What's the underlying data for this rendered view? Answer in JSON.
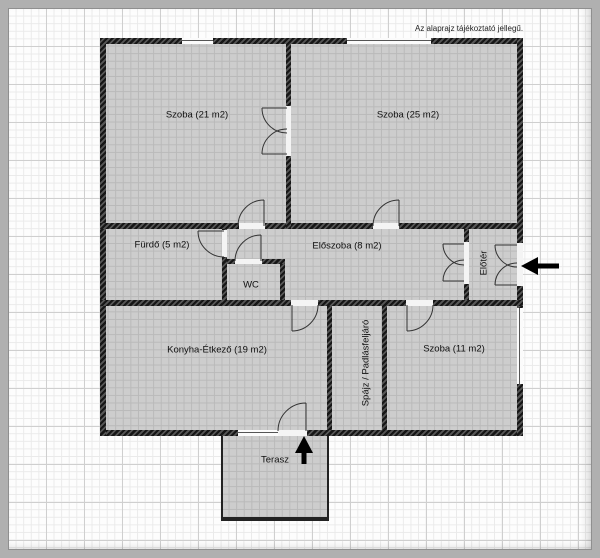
{
  "note": "Az alaprajz tájékoztató jellegű.",
  "rooms": [
    {
      "id": "szoba-21",
      "label": "Szoba (21 m2)",
      "area_m2": 21
    },
    {
      "id": "szoba-25",
      "label": "Szoba (25 m2)",
      "area_m2": 25
    },
    {
      "id": "furdo",
      "label": "Fürdő (5 m2)",
      "area_m2": 5
    },
    {
      "id": "wc",
      "label": "WC"
    },
    {
      "id": "eloszoba",
      "label": "Előszoba (8 m2)",
      "area_m2": 8
    },
    {
      "id": "eloter",
      "label": "Előtér"
    },
    {
      "id": "konyha-etkezo",
      "label": "Konyha-Étkező (19 m2)",
      "area_m2": 19
    },
    {
      "id": "spajz-padlasfeljaro",
      "label": "Spájz / Padlásfeljáró"
    },
    {
      "id": "szoba-11",
      "label": "Szoba (11 m2)",
      "area_m2": 11
    },
    {
      "id": "terasz",
      "label": "Terasz"
    }
  ],
  "annotations": {
    "entrance_arrow_direction": "left",
    "terasz_arrow_direction": "up"
  },
  "colors": {
    "room_fill": "#cdcdcd",
    "wall": "#1a1a1a",
    "grid_minor": "#eaeaea",
    "grid_major": "#cfcfcf",
    "frame": "#b0b0b0",
    "arrow": "#000000"
  }
}
